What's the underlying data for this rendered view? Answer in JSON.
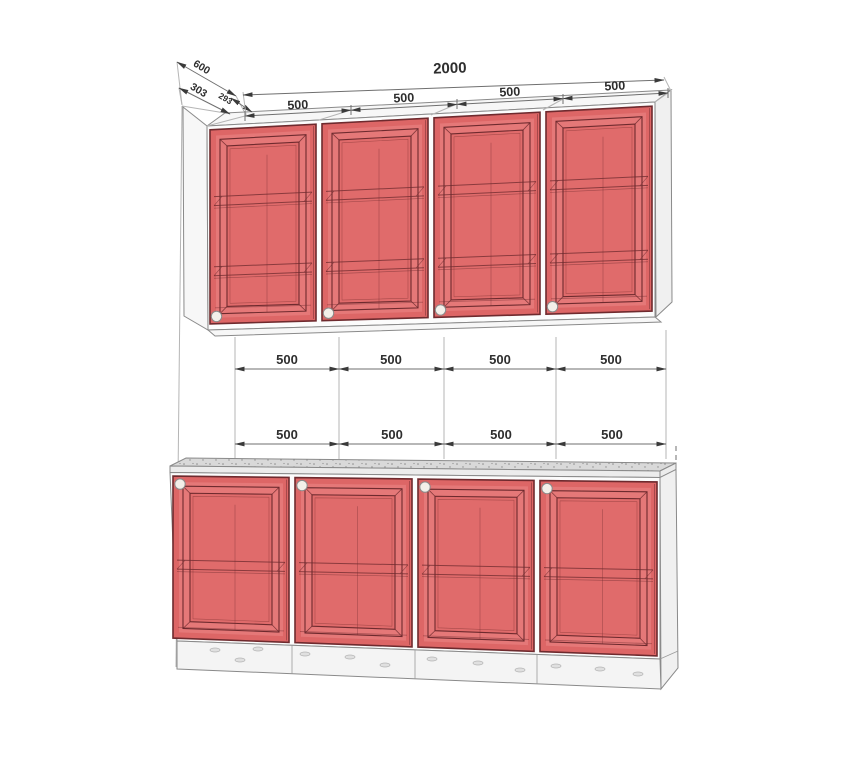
{
  "dimensions": {
    "overall_width": "2000",
    "depth": [
      "600",
      "303",
      "293"
    ],
    "top_row": [
      "500",
      "500",
      "500",
      "500"
    ],
    "middle_row": [
      "500",
      "500",
      "500",
      "500"
    ],
    "lower_row": [
      "500",
      "500",
      "500",
      "500"
    ]
  },
  "colors": {
    "door_fill": "#e26c6c",
    "door_rim": "#dd6666",
    "door_frame_band": "#e57878",
    "door_panel": "#e06b6b",
    "door_stroke": "#6e2a2e",
    "door_inner_faint": "#a84a4a",
    "carcass_fill": "#fcfcfc",
    "side_fill": "#f0f0f0",
    "top_fill": "#f7f7f7",
    "counter_fill": "#d9d9d9",
    "counter_speck": "#8c8c8c",
    "counter_edge": "#ececec",
    "plinth_fill": "#f4f4f4",
    "knob_fill": "#f3efe9",
    "dim_text": "#2e2e2e"
  }
}
